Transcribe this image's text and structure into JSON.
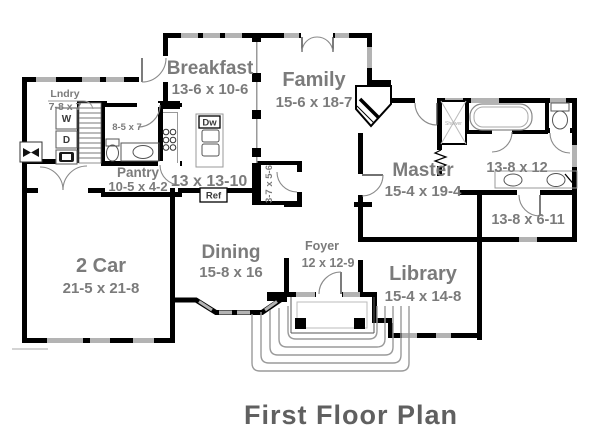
{
  "plan": {
    "title": "First Floor Plan",
    "rooms": {
      "breakfast": {
        "name": "Breakfast",
        "dims": "13-6 x 10-6"
      },
      "family": {
        "name": "Family",
        "dims": "15-6 x 18-7"
      },
      "laundry": {
        "name": "Lndry",
        "dims": "7-8 x 7"
      },
      "hall_bath": {
        "dims": "8-5 x 7"
      },
      "pantry": {
        "name": "Pantry",
        "dims": "10-5 x 4-2"
      },
      "kitchen": {
        "dims": "13 x 13-10"
      },
      "powder": {
        "dims": "3-7 x 5-6"
      },
      "master": {
        "name": "Master",
        "dims": "15-4 x 19-4"
      },
      "master_bath": {
        "dims": "13-8 x 12"
      },
      "master_closet": {
        "dims": "13-8 x 6-11"
      },
      "garage": {
        "name": "2 Car",
        "dims": "21-5 x 21-8"
      },
      "dining": {
        "name": "Dining",
        "dims": "15-8 x 16"
      },
      "foyer": {
        "name": "Foyer",
        "dims": "12 x 12-9"
      },
      "library": {
        "name": "Library",
        "dims": "15-4 x 14-8"
      }
    },
    "fixtures": {
      "washer": "W",
      "dryer": "D",
      "dishwasher": "Dw",
      "refrigerator": "Ref",
      "shower": "Shower"
    },
    "colors": {
      "wall": "#000000",
      "label_gray": "#7b7b7b",
      "title_gray": "#606060",
      "window_gray": "#b3b3b3",
      "steps_gray": "#9a9a9a"
    }
  }
}
